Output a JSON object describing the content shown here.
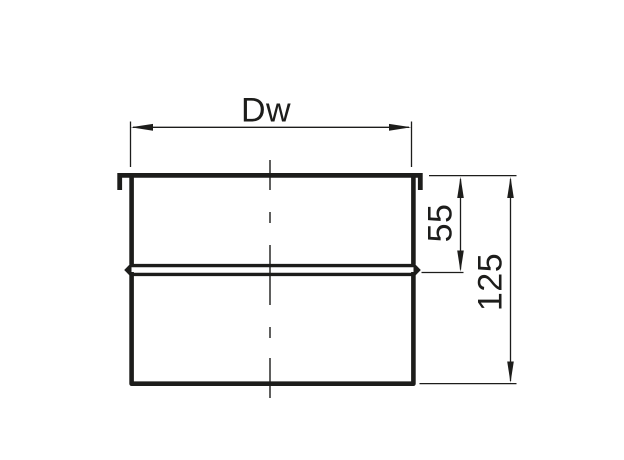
{
  "drawing": {
    "background": "#ffffff",
    "line_color": "#1d1d1b",
    "dimensions": {
      "inner_diameter": {
        "label": "Dw"
      },
      "upper_section_height": {
        "label": "55"
      },
      "overall_height": {
        "label": "125"
      }
    }
  }
}
